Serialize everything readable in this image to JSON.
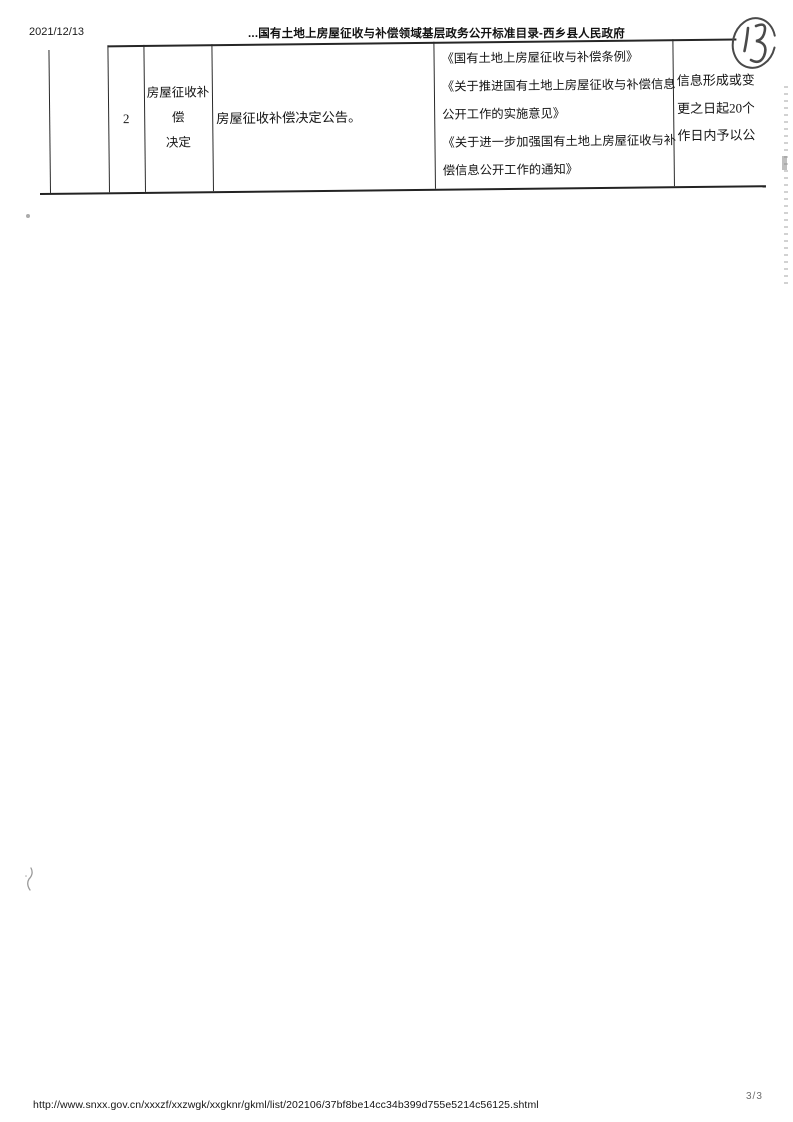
{
  "header": {
    "date": "2021/12/13",
    "title": "...国有土地上房屋征收与补偿领域基层政务公开标准目录-西乡县人民政府",
    "handwritten_page_mark": "13"
  },
  "table": {
    "row_number": "2",
    "category": {
      "line1": "房屋征收补偿",
      "line2": "决定"
    },
    "disclosure_item": "房屋征收补偿决定公告。",
    "legal_basis_lines": [
      "《国有土地上房屋征收与补偿条例》",
      "《关于推进国有土地上房屋征收与补偿信息",
      "公开工作的实施意见》",
      "《关于进一步加强国有土地上房屋征收与补",
      "偿信息公开工作的通知》"
    ],
    "timing_lines": [
      "信息形成或变",
      "更之日起20个",
      "作日内予以公"
    ]
  },
  "footer": {
    "url": "http://www.snxx.gov.cn/xxxzf/xxzwgk/xxgknr/gkml/list/202106/37bf8be14cc34b399d755e5214c56125.shtml",
    "page_indicator": "3/3"
  },
  "colors": {
    "ink": "#1b1b1b",
    "table_border": "#262626",
    "pen": "#474747"
  }
}
